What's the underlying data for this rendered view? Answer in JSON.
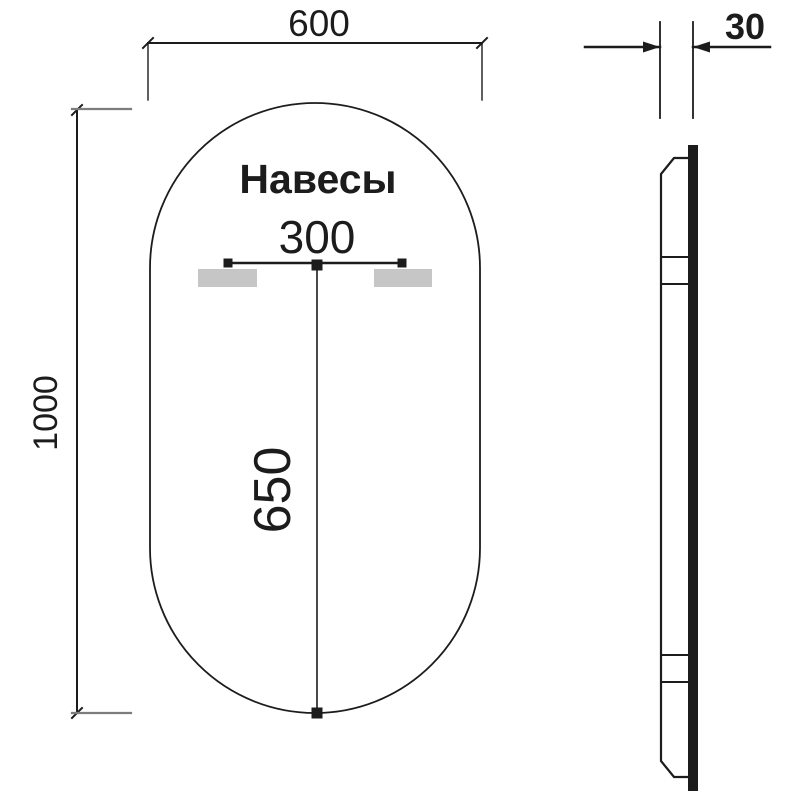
{
  "title": "Mirror dimensions technical drawing",
  "front_view": {
    "width_label": "600",
    "height_label": "1000",
    "hangers_label": "Навесы",
    "hanger_spacing_label": "300",
    "mount_drop_label": "650"
  },
  "side_view": {
    "depth_label": "30"
  },
  "colors": {
    "line": "#1c1c1c",
    "dim_gray": "#7d7d7d",
    "hanger_fill": "#c6c6c6",
    "background": "#ffffff"
  }
}
